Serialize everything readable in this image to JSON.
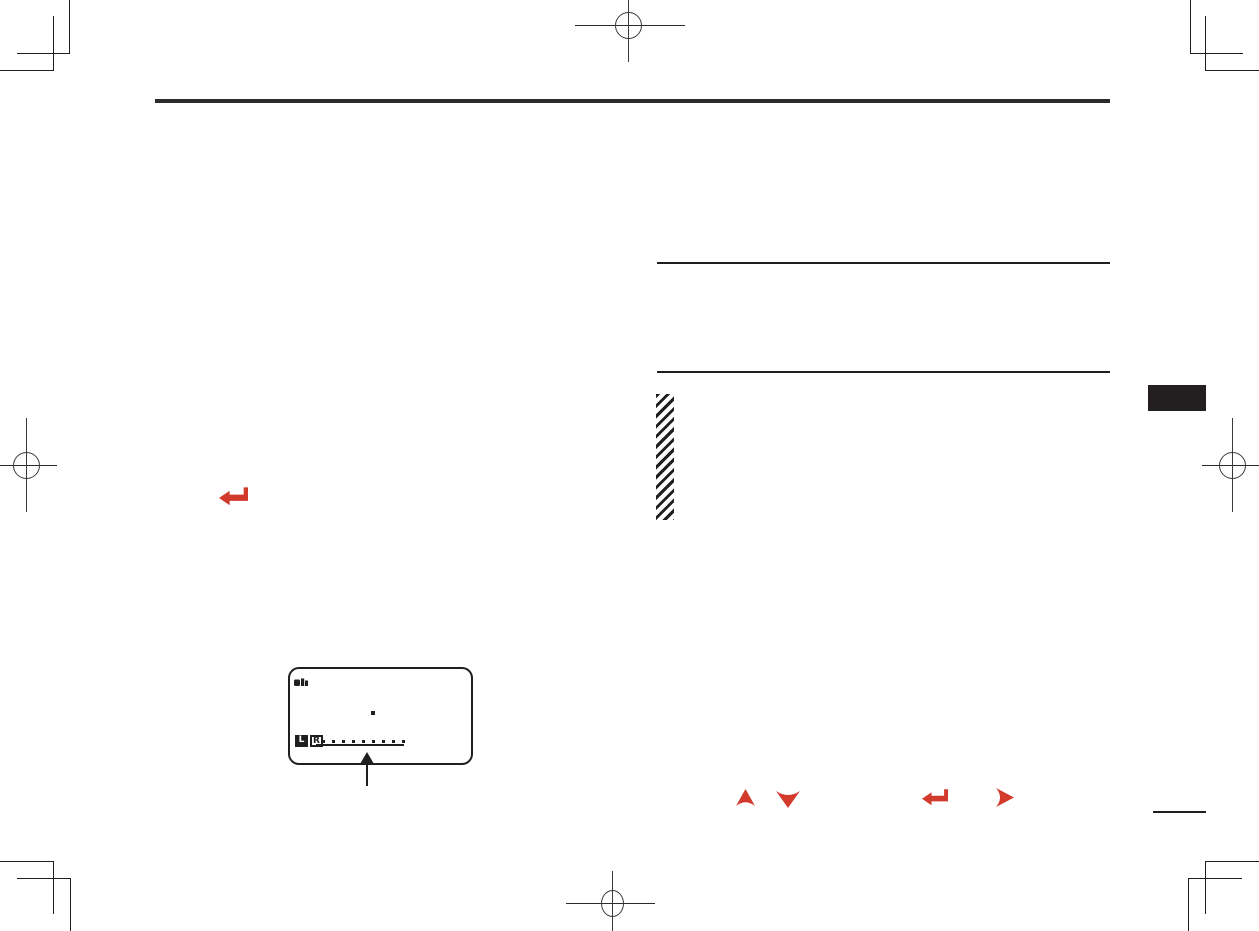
{
  "meta": {
    "kind": "scanned manual page",
    "page_background": "#ffffff"
  },
  "colors": {
    "ink": "#1f1f1f",
    "accent_red": "#d23a2b",
    "tab_black": "#231f20"
  },
  "lcd": {
    "status_icon": "cassette-status-icon",
    "record_dot_icon": "record-dot",
    "left_channel_label": "L",
    "right_channel_label": "R",
    "meter_dot_count": 9,
    "callout": "up-arrow pointing at level meter"
  },
  "icons": {
    "inline_enter": "enter-return-arrow-icon",
    "buttons_row": [
      "up-arrow-icon",
      "down-arrow-icon",
      "enter-return-arrow-icon",
      "right-arrow-icon"
    ]
  },
  "print_marks": {
    "registration": [
      "top-center",
      "left-edge",
      "right-edge",
      "bottom-center"
    ],
    "crop_corners": [
      "top-left",
      "top-right",
      "bottom-left",
      "bottom-right"
    ]
  }
}
